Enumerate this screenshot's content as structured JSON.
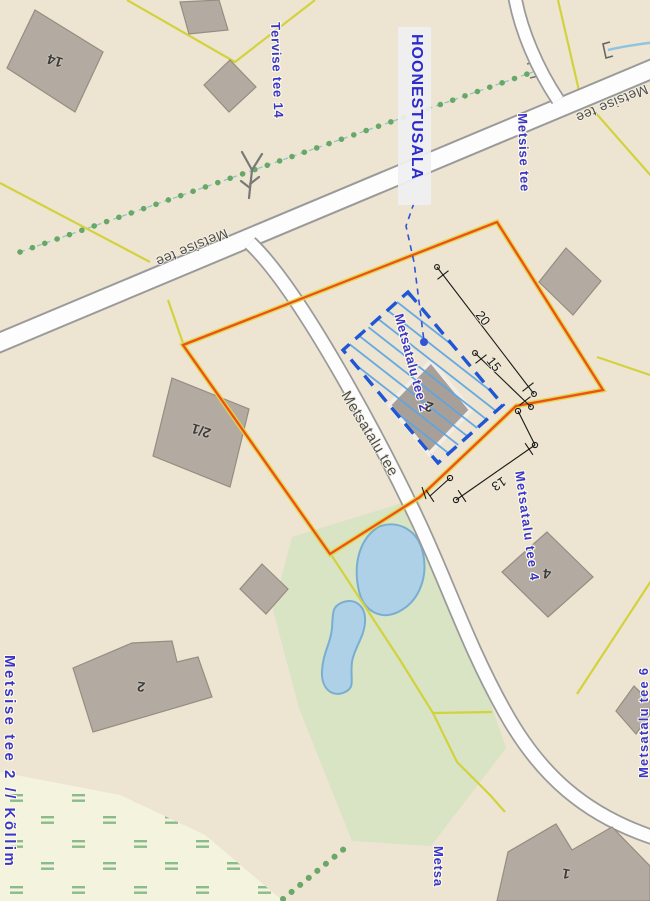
{
  "canvas": {
    "width": 650,
    "height": 901
  },
  "plan": {
    "callout_label": "HOONESTUSALA",
    "dimensions": {
      "d20": "20",
      "d15": "15",
      "d13": "13"
    }
  },
  "streets": {
    "metsise_tee_label_left": "Metsise tee",
    "metsise_tee_label_right": "Metsise tee",
    "metsatalu_tee_label": "Metsatalu tee"
  },
  "parcels": {
    "tervise_tee_14": "Tervise tee 14",
    "metsise_tee": "Metsise tee",
    "metsatalu_tee_2": "Metsatalu tee 2",
    "metsatalu_tee_4": "Metsatalu tee 4",
    "metsatalu_tee_6": "Metsatalu tee 6",
    "metsise_tee_2_kollim": "Metsise tee 2 // Kõllim",
    "metsa_partial": "Metsa"
  },
  "buildings": {
    "b14": "14",
    "b2_1": "2/1",
    "b2_plan": "2",
    "b2_south": "2",
    "b4": "4",
    "b1": "1"
  },
  "icons": {
    "tree": "tree-icon",
    "path_end_bracket": "bracket-marker-icon",
    "stream_start_bracket": "bracket-marker-icon"
  },
  "colors": {
    "land": "#ede5d1",
    "green_area": "#d8e4c3",
    "meadow": "#f4f3de",
    "water_fill": "#aed1e8",
    "water_stroke": "#78aed2",
    "road_fill": "#fdfdfd",
    "road_casing": "#9a9a9a",
    "parcel_line": "#d2d23e",
    "plan_boundary": "#f04e1c",
    "building_area_outline": "#1e56d6",
    "building_area_hatch": "#5ba4e4",
    "building_fill": "#b3aaa1",
    "address_label": "#3a35cc",
    "street_label": "#4f4f4f",
    "dimension_line": "#1a1a1a"
  }
}
